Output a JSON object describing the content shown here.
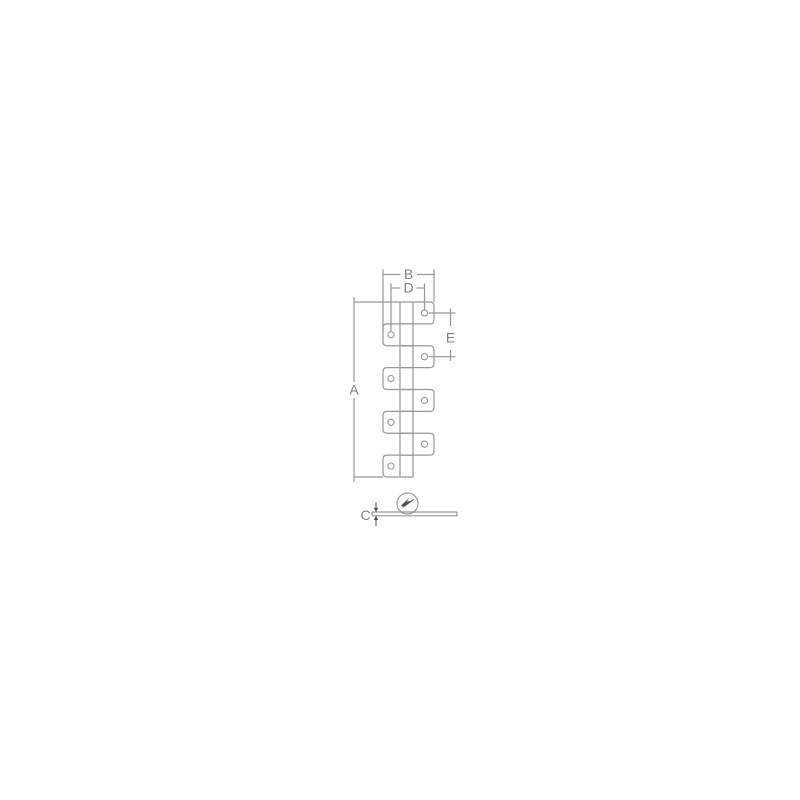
{
  "colors": {
    "background": "#ffffff",
    "line": "#94989b",
    "text": "#7d8083",
    "marker": "#4d5052"
  },
  "drawing": {
    "dimensions": {
      "a": "A",
      "b": "B",
      "c": "C",
      "d": "D",
      "e": "E"
    },
    "front_view": {
      "right_tab_count": 4,
      "left_tab_count": 4,
      "hole_count": 8
    },
    "side_view": {
      "marker_icon": "direction-marker-icon"
    }
  }
}
